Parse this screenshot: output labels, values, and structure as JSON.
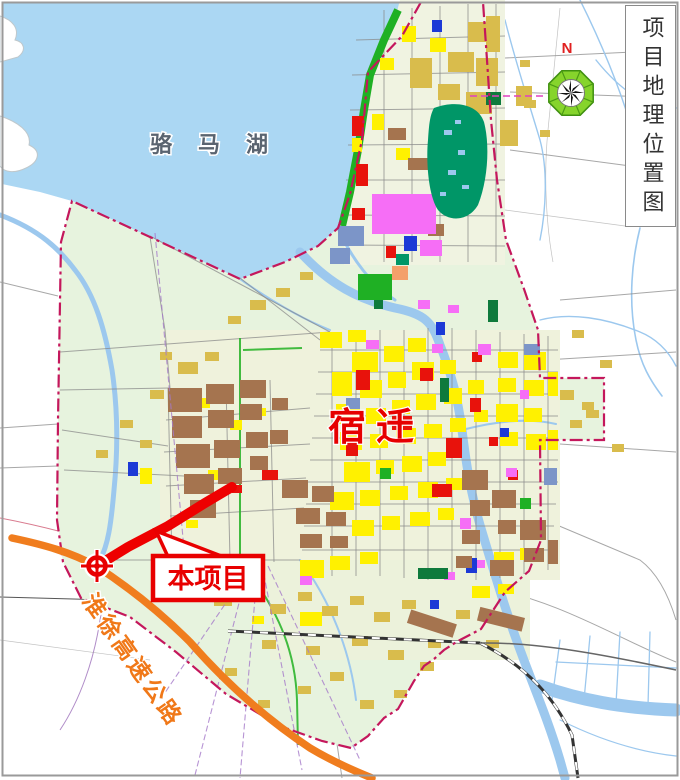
{
  "sidebar": {
    "title": "项目地理位置图"
  },
  "map": {
    "lake_label": "骆马湖",
    "city_label": "宿迁",
    "callout_label": "本项目",
    "expressway_label": "淮徐高速公路",
    "north_label": "N"
  },
  "colors": {
    "lake_blue": "#ABD7F3",
    "planning_area_green": "#E7F3DE",
    "project_red": "#EE0000",
    "expressway_orange": "#F07D1E",
    "boundary_crimson": "#C4175C",
    "compass_green": "#86D42C",
    "city_label_red": "#E60000",
    "lake_label_gray": "#5A6470"
  }
}
